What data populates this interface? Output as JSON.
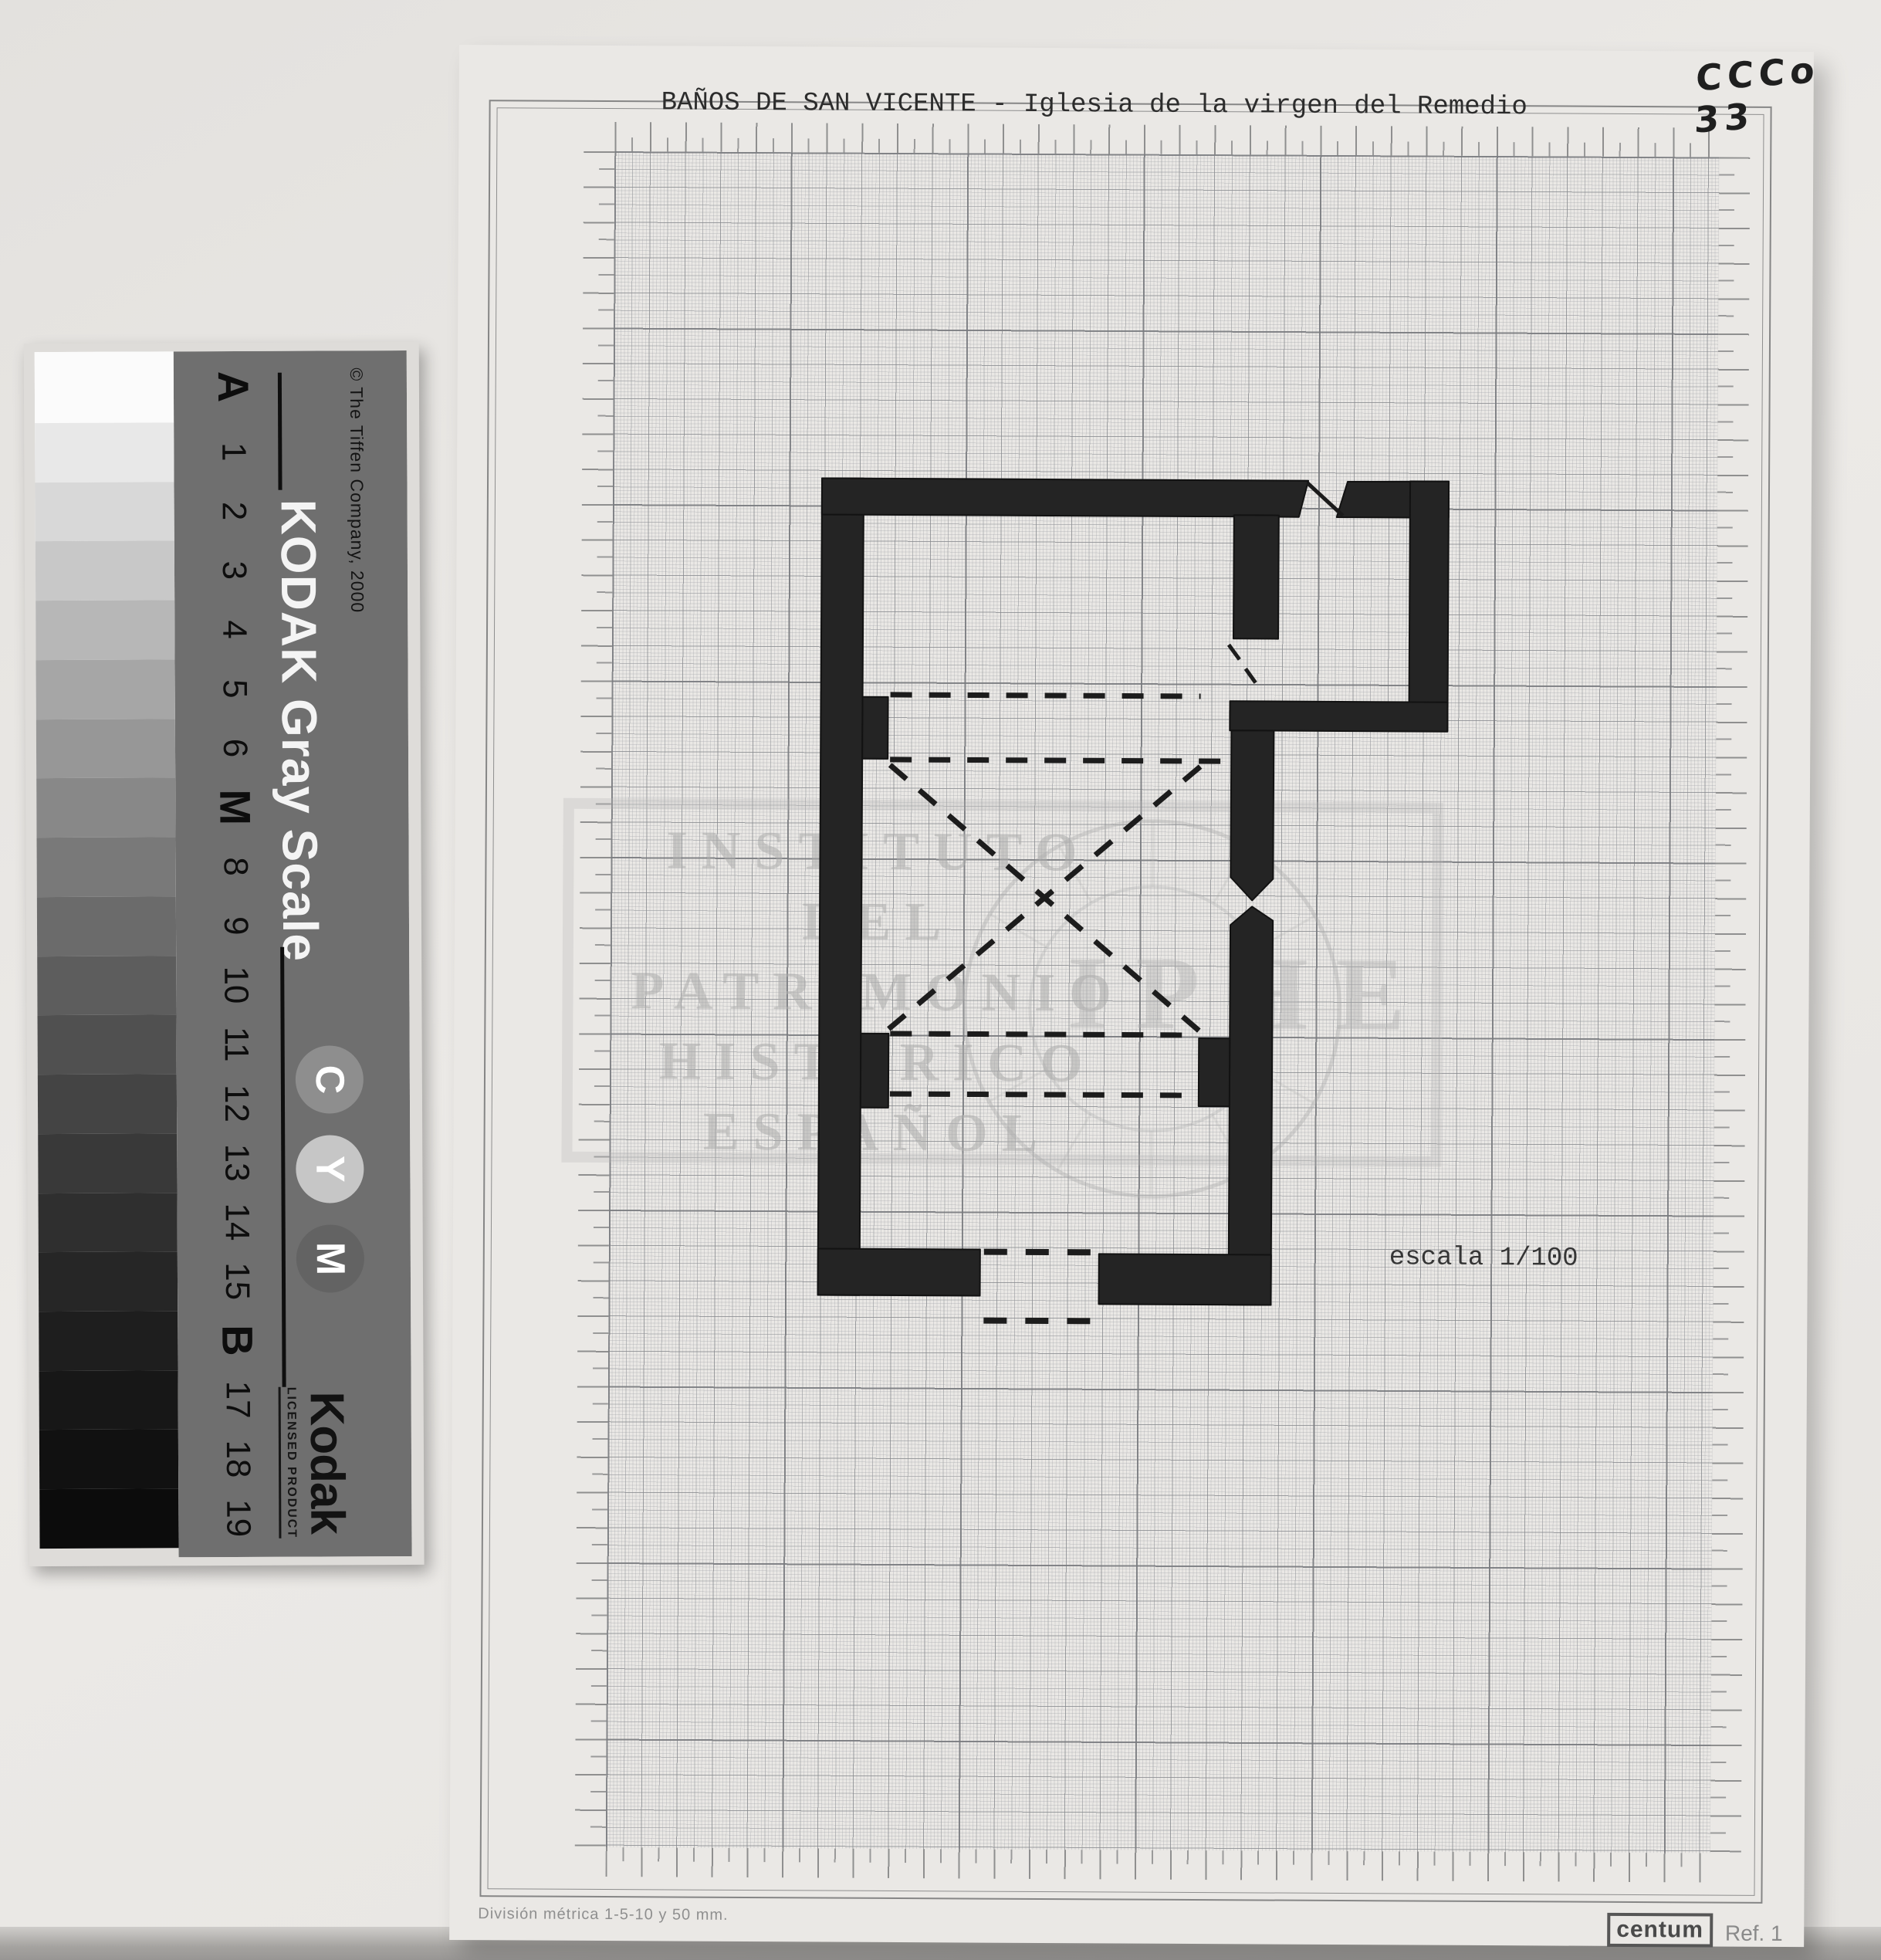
{
  "annotation": {
    "code": "CCCo 33"
  },
  "sheet": {
    "title": "BAÑOS DE SAN VICENTE - Iglesia de la virgen del Remedio",
    "scale_label": "escala 1/100",
    "division_label": "División métrica 1-5-10 y 50 mm.",
    "brand_label": "centum",
    "ref_label": "Ref. 1",
    "paper_color": "#eae8e5",
    "grid_major_color": "#7a7c80",
    "ink_color": "#242424"
  },
  "watermark": {
    "lines": [
      "INSTITUTO",
      "DEL",
      "PATRIMONIO",
      "HISTÓRICO",
      "ESPAÑOL"
    ],
    "acronym": "IPHE"
  },
  "gray_scale_card": {
    "copyright": "© The Tiffen Company, 2000",
    "brand": "KODAK Gray Scale",
    "logo": "Kodak",
    "licensed": "LICENSED PRODUCT",
    "card_color": "#6f6f6f",
    "circles": [
      {
        "label": "C",
        "color": "#8e8e8e"
      },
      {
        "label": "Y",
        "color": "#c6c6c6"
      },
      {
        "label": "M",
        "color": "#636363"
      }
    ],
    "steps": [
      {
        "label": "A",
        "color": "#fbfbfb",
        "bold": true
      },
      {
        "label": "1",
        "color": "#e8e8e8"
      },
      {
        "label": "2",
        "color": "#d8d8d8"
      },
      {
        "label": "3",
        "color": "#c8c8c8"
      },
      {
        "label": "4",
        "color": "#b7b7b7"
      },
      {
        "label": "5",
        "color": "#a6a6a6"
      },
      {
        "label": "6",
        "color": "#979797"
      },
      {
        "label": "M",
        "color": "#888888",
        "bold": true
      },
      {
        "label": "8",
        "color": "#797979"
      },
      {
        "label": "9",
        "color": "#6b6b6b"
      },
      {
        "label": "10",
        "color": "#5d5d5d"
      },
      {
        "label": "11",
        "color": "#505050"
      },
      {
        "label": "12",
        "color": "#444444"
      },
      {
        "label": "13",
        "color": "#393939"
      },
      {
        "label": "14",
        "color": "#2f2f2f"
      },
      {
        "label": "15",
        "color": "#262626"
      },
      {
        "label": "B",
        "color": "#1e1e1e",
        "bold": true
      },
      {
        "label": "17",
        "color": "#171717"
      },
      {
        "label": "18",
        "color": "#111111"
      },
      {
        "label": "19",
        "color": "#0c0c0c"
      }
    ]
  }
}
